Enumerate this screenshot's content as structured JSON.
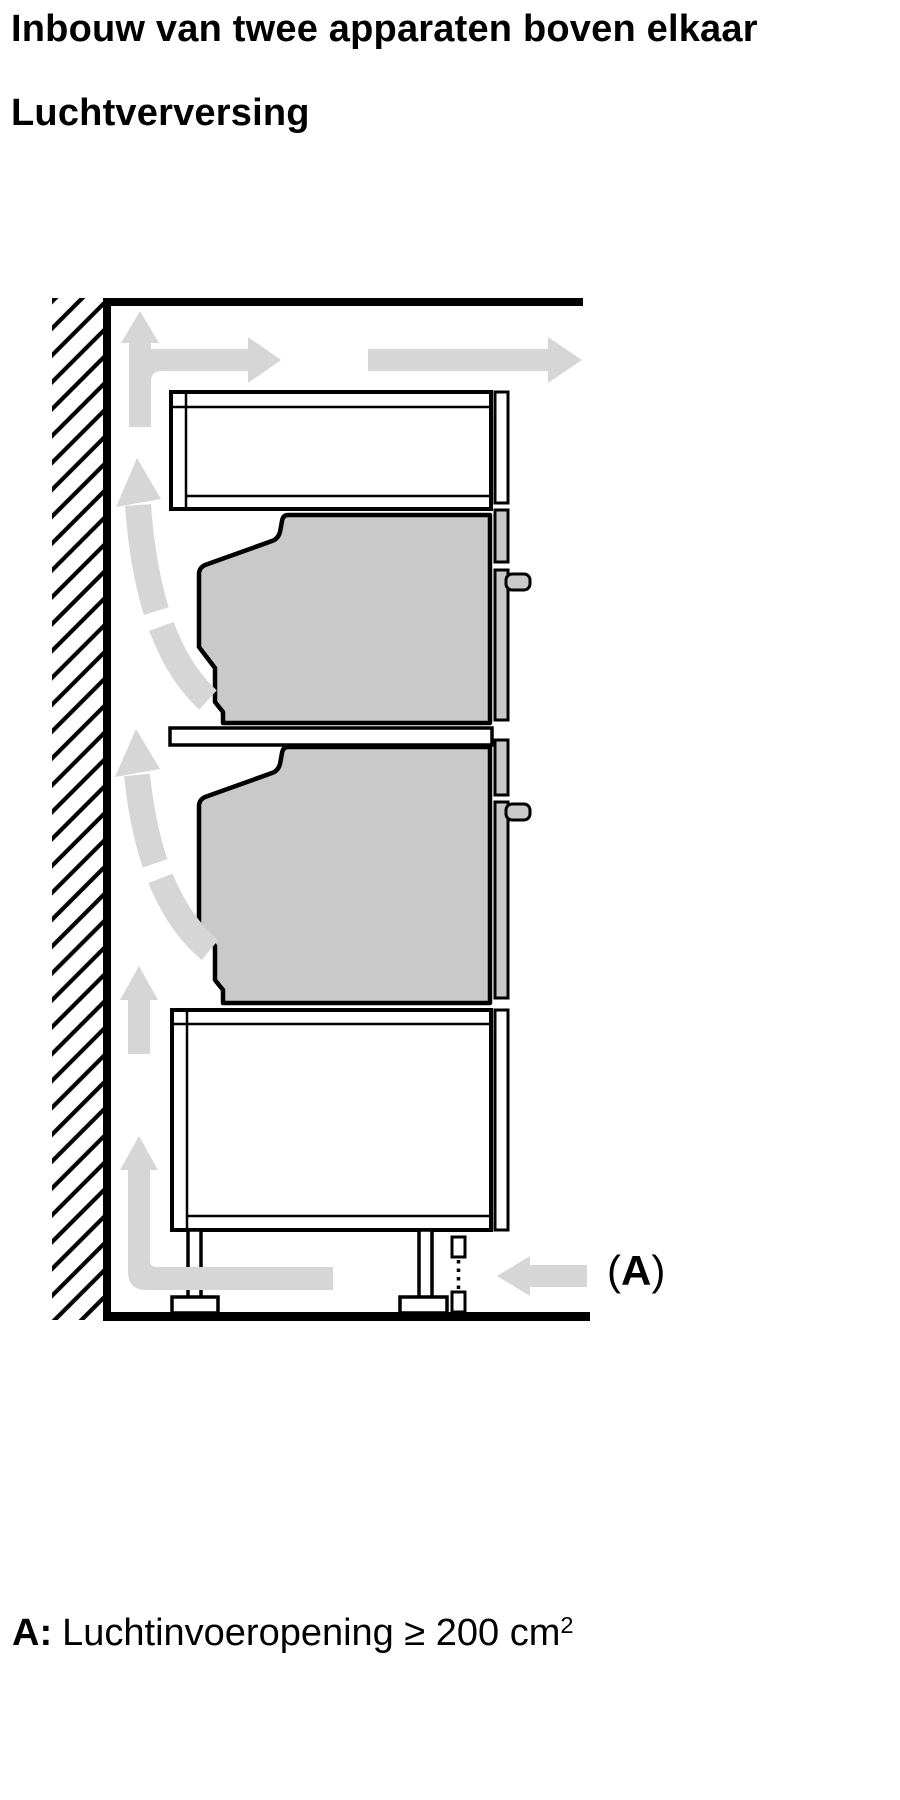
{
  "page": {
    "title_line1": "Inbouw van twee apparaten boven elkaar",
    "title_line2": "Luchtverversing"
  },
  "diagram": {
    "type": "appliance-installation-side-view",
    "callout_a": {
      "open": "(",
      "letter": "A",
      "close": ")"
    },
    "colors": {
      "appliance_fill": "#c9c9c9",
      "airflow_arrow": "#d6d6d6",
      "outline": "#000000",
      "background": "#ffffff"
    }
  },
  "caption": {
    "term": "A:",
    "definition": "Luchtinvoeropening ≥ 200 cm",
    "superscript": "2"
  }
}
